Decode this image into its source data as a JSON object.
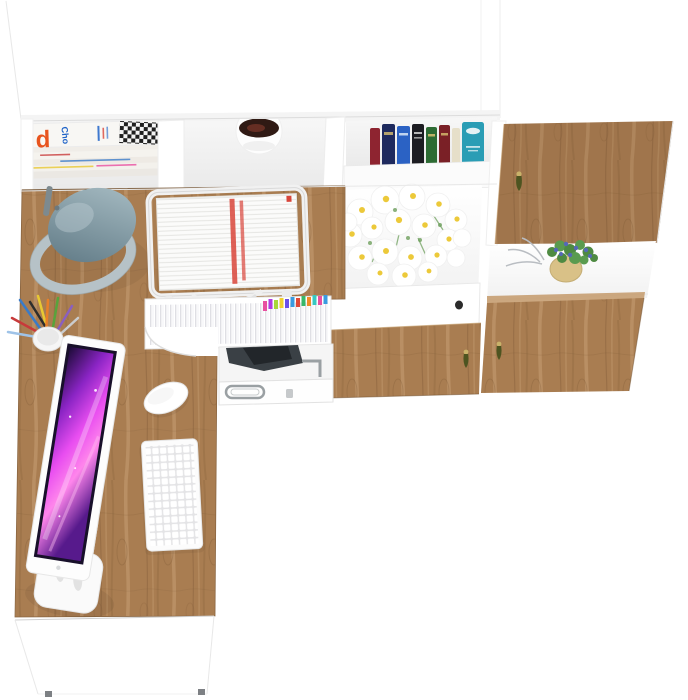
{
  "scene": {
    "description": "Top-down product render of a white corner desk workstation with oak wood accents: wall hutch with open cubbies and oak doors above, L-shaped desk with computer setup below",
    "magazine": {
      "big_letter": "d",
      "title_fragment": "Cho"
    },
    "objects": [
      "hutch-top-panel",
      "magazine-stack",
      "cubby-plant-pot",
      "book-row",
      "oak-door-top-right",
      "daisy-bouquet",
      "potted-plant-blue-flowers",
      "oak-doors-bottom",
      "desk-lamp",
      "letter-tray-documents",
      "pencil-cup",
      "hanging-file-drawer",
      "equipment-bay",
      "equipment-drawer",
      "monitor-purple-screen",
      "keyboard",
      "mouse",
      "oak-desktop",
      "desk-front-panel"
    ]
  },
  "colors": {
    "bg": "#ffffff",
    "woodLight": "#c79f72",
    "woodMid": "#a97d51",
    "woodDark": "#7b5733",
    "woodEdge": "#8a6540",
    "woodTint": "#5f4226",
    "magOrange": "#e8541e",
    "magBlue": "#1e63c8",
    "checkDark": "#1f1f1f",
    "bookRed": "#8e2430",
    "bookNavy": "#1e2a5e",
    "bookBlue": "#2b62c4",
    "bookBlack": "#1c1c21",
    "bookGreen": "#2d6b33",
    "bookMaroon": "#7a2026",
    "bookCream": "#e6dfc9",
    "bookTeal": "#2a9db5",
    "bookGold": "#d8c070",
    "handleOlive": "#4d5420",
    "handleGold": "#c9b26a",
    "knobBlack": "#2b2b2b",
    "plantPotDark": "#301a14",
    "plantPotRed": "#6e3326",
    "daisyYellow": "#ecc93a",
    "stemGreen": "#6fa05e",
    "leafGreen": "#4e8a42",
    "leafGreen2": "#5a9b4f",
    "potTan": "#d9c187",
    "flowerBlue": "#5468b8",
    "twigGray": "#b9bdc2",
    "lampDark": "#5c7682",
    "lampLight": "#aabfc6",
    "lampBase": "#b6c2c7",
    "lampRod": "#7d8a8f",
    "screenFrame": "#18102a",
    "screenTop": "#1d0b38",
    "screenMid": "#8a24c4",
    "screenBright": "#e84df0",
    "screenPink": "#ff86ec",
    "screenBottom": "#571a8c",
    "equipDark": "#3a4045",
    "equipDarker": "#22262a",
    "metalGray": "#9aa0a3",
    "docRed": "#d8453a",
    "tabPink": "#e84fa0",
    "tabPurple": "#b13ce0",
    "tabViolet": "#6a4fe8",
    "tabBlue": "#3a9be0",
    "tabGreen": "#38b86a",
    "tabLime": "#a8d838",
    "tabYellow": "#f0d030",
    "tabOrange": "#f08c28",
    "tabRed": "#e04838",
    "tabTeal": "#38c8c0",
    "penYellow": "#e8c832",
    "penGreen": "#58a33c",
    "penBlue": "#3a7bc8",
    "penRed": "#c83a3a",
    "penBlack": "#2d2d2d",
    "penOrange": "#e87f28",
    "penPurple": "#8a5fc0",
    "penSky": "#9fc3e8",
    "penSilver": "#caccce"
  }
}
